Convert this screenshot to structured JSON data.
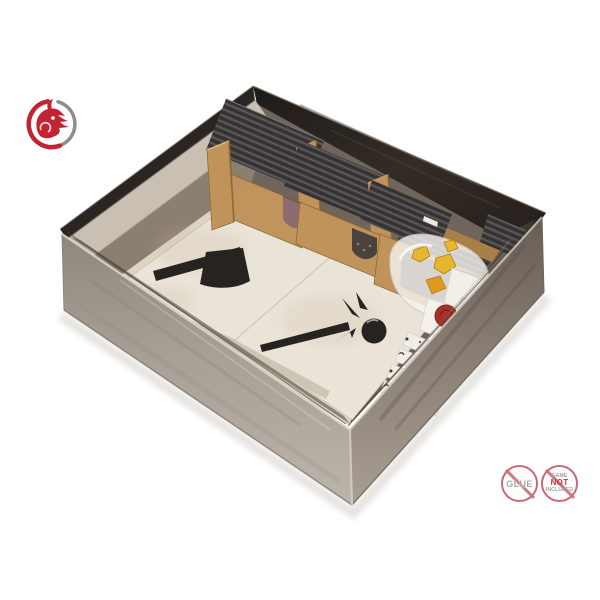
{
  "page": {
    "background": "#ffffff",
    "type": "product-photo"
  },
  "logo": {
    "name": "dragon swirl logo",
    "red": "#c32434",
    "gray": "#8d8d8d"
  },
  "scene": {
    "subject": "board game box with wooden card insert organizer, weapon tiles, card stacks and token bag",
    "box_exterior_dark": "#2b2522",
    "box_wall_left": "#a59c92",
    "box_wall_right": "#847a70",
    "interior_wall": "#c9c0b3",
    "insert_wood": "#c0935a",
    "insert_wood_shade": "#a87f46",
    "card_stack": "#3f3c3d",
    "card_stripe": "#6c686a",
    "tile": "#eae3d7",
    "tile_icon_color": "#262320",
    "tile_icons": [
      "axe",
      "mace"
    ],
    "token_yellow": "#e8b52e",
    "token_orange": "#dd9a1f",
    "seal_red": "#a63226",
    "card_face_pink": "#8d6b72",
    "bag_white": "#f5f3ef"
  },
  "badges": {
    "no_glue": {
      "label": "GLUE",
      "ring": "#c96b76",
      "text": "#a4a8a8"
    },
    "game_not_included": {
      "line1": "GAME",
      "line2": "NOT",
      "line3": "INCLUDED",
      "ring": "#c96b76",
      "accent": "#c23843",
      "text": "#9da0a1"
    }
  }
}
